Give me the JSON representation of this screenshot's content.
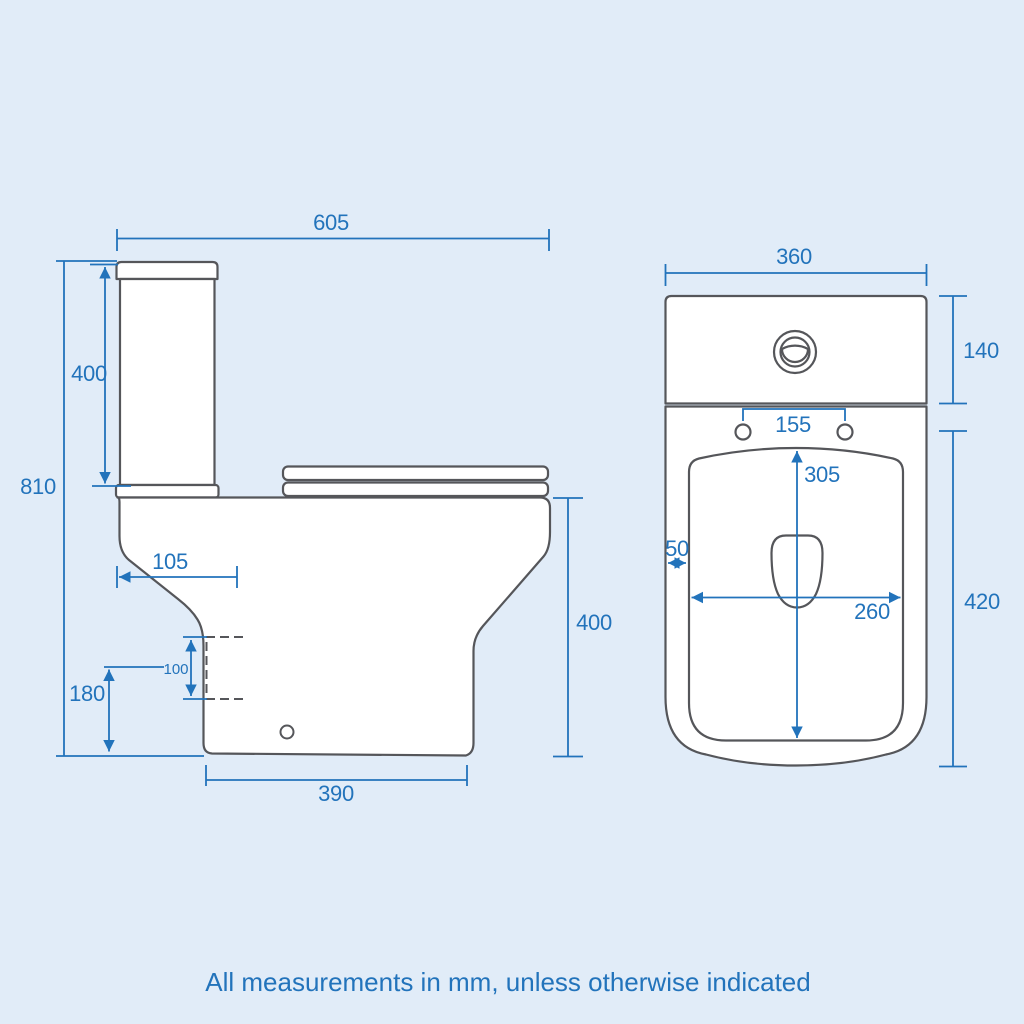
{
  "note": "All measurements in mm, unless otherwise indicated",
  "colors": {
    "background": "#e1ecf8",
    "fixture_outline": "#55565a",
    "fixture_fill": "#ffffff",
    "dimension_blue": "#2273bb"
  },
  "side_view": {
    "dimensions": {
      "overall_depth": "605",
      "cistern_height": "400",
      "overall_height": "810",
      "trap_setback": "105",
      "outlet_size": "100",
      "outlet_height": "180",
      "base_depth": "390",
      "pan_height": "400"
    }
  },
  "front_view": {
    "dimensions": {
      "overall_width": "360",
      "cistern_height": "140",
      "seat_hole_spacing": "155",
      "bowl_opening_depth": "305",
      "rim_width": "50",
      "bowl_opening_width": "260",
      "pan_height": "420"
    }
  }
}
